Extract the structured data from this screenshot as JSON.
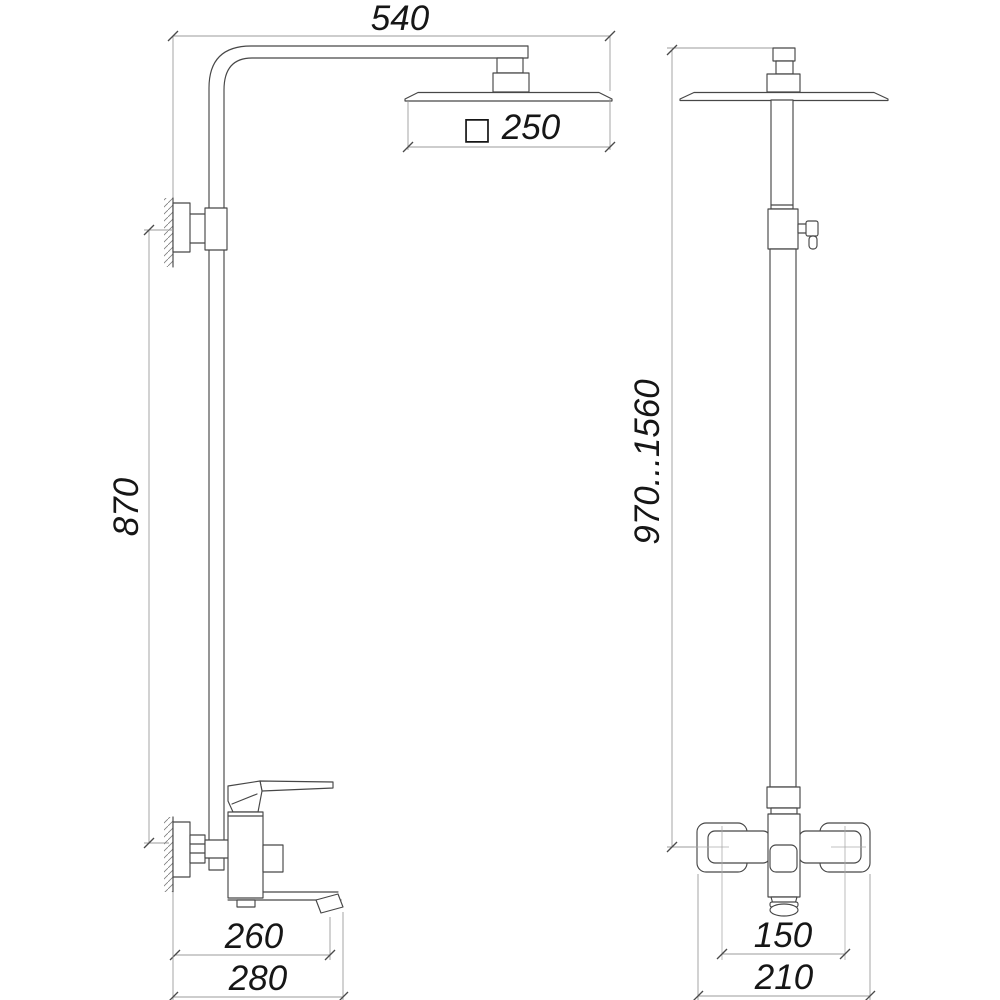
{
  "drawing": {
    "type": "technical-dimension-diagram",
    "subject": "wall-mounted shower column with rain head and bath mixer",
    "background_color": "#ffffff",
    "object_line_color": "#474747",
    "dimension_line_color": "#9b9b9b",
    "text_color": "#161616",
    "dimensions": {
      "side_view": {
        "arm_reach": "540",
        "head_size_symbol": "□",
        "head_size": "250",
        "column_height": "870",
        "spout_reach": "260",
        "total_depth": "280"
      },
      "front_view": {
        "height_range": "970...1560",
        "mount_centers": "150",
        "overall_width": "210"
      }
    }
  }
}
